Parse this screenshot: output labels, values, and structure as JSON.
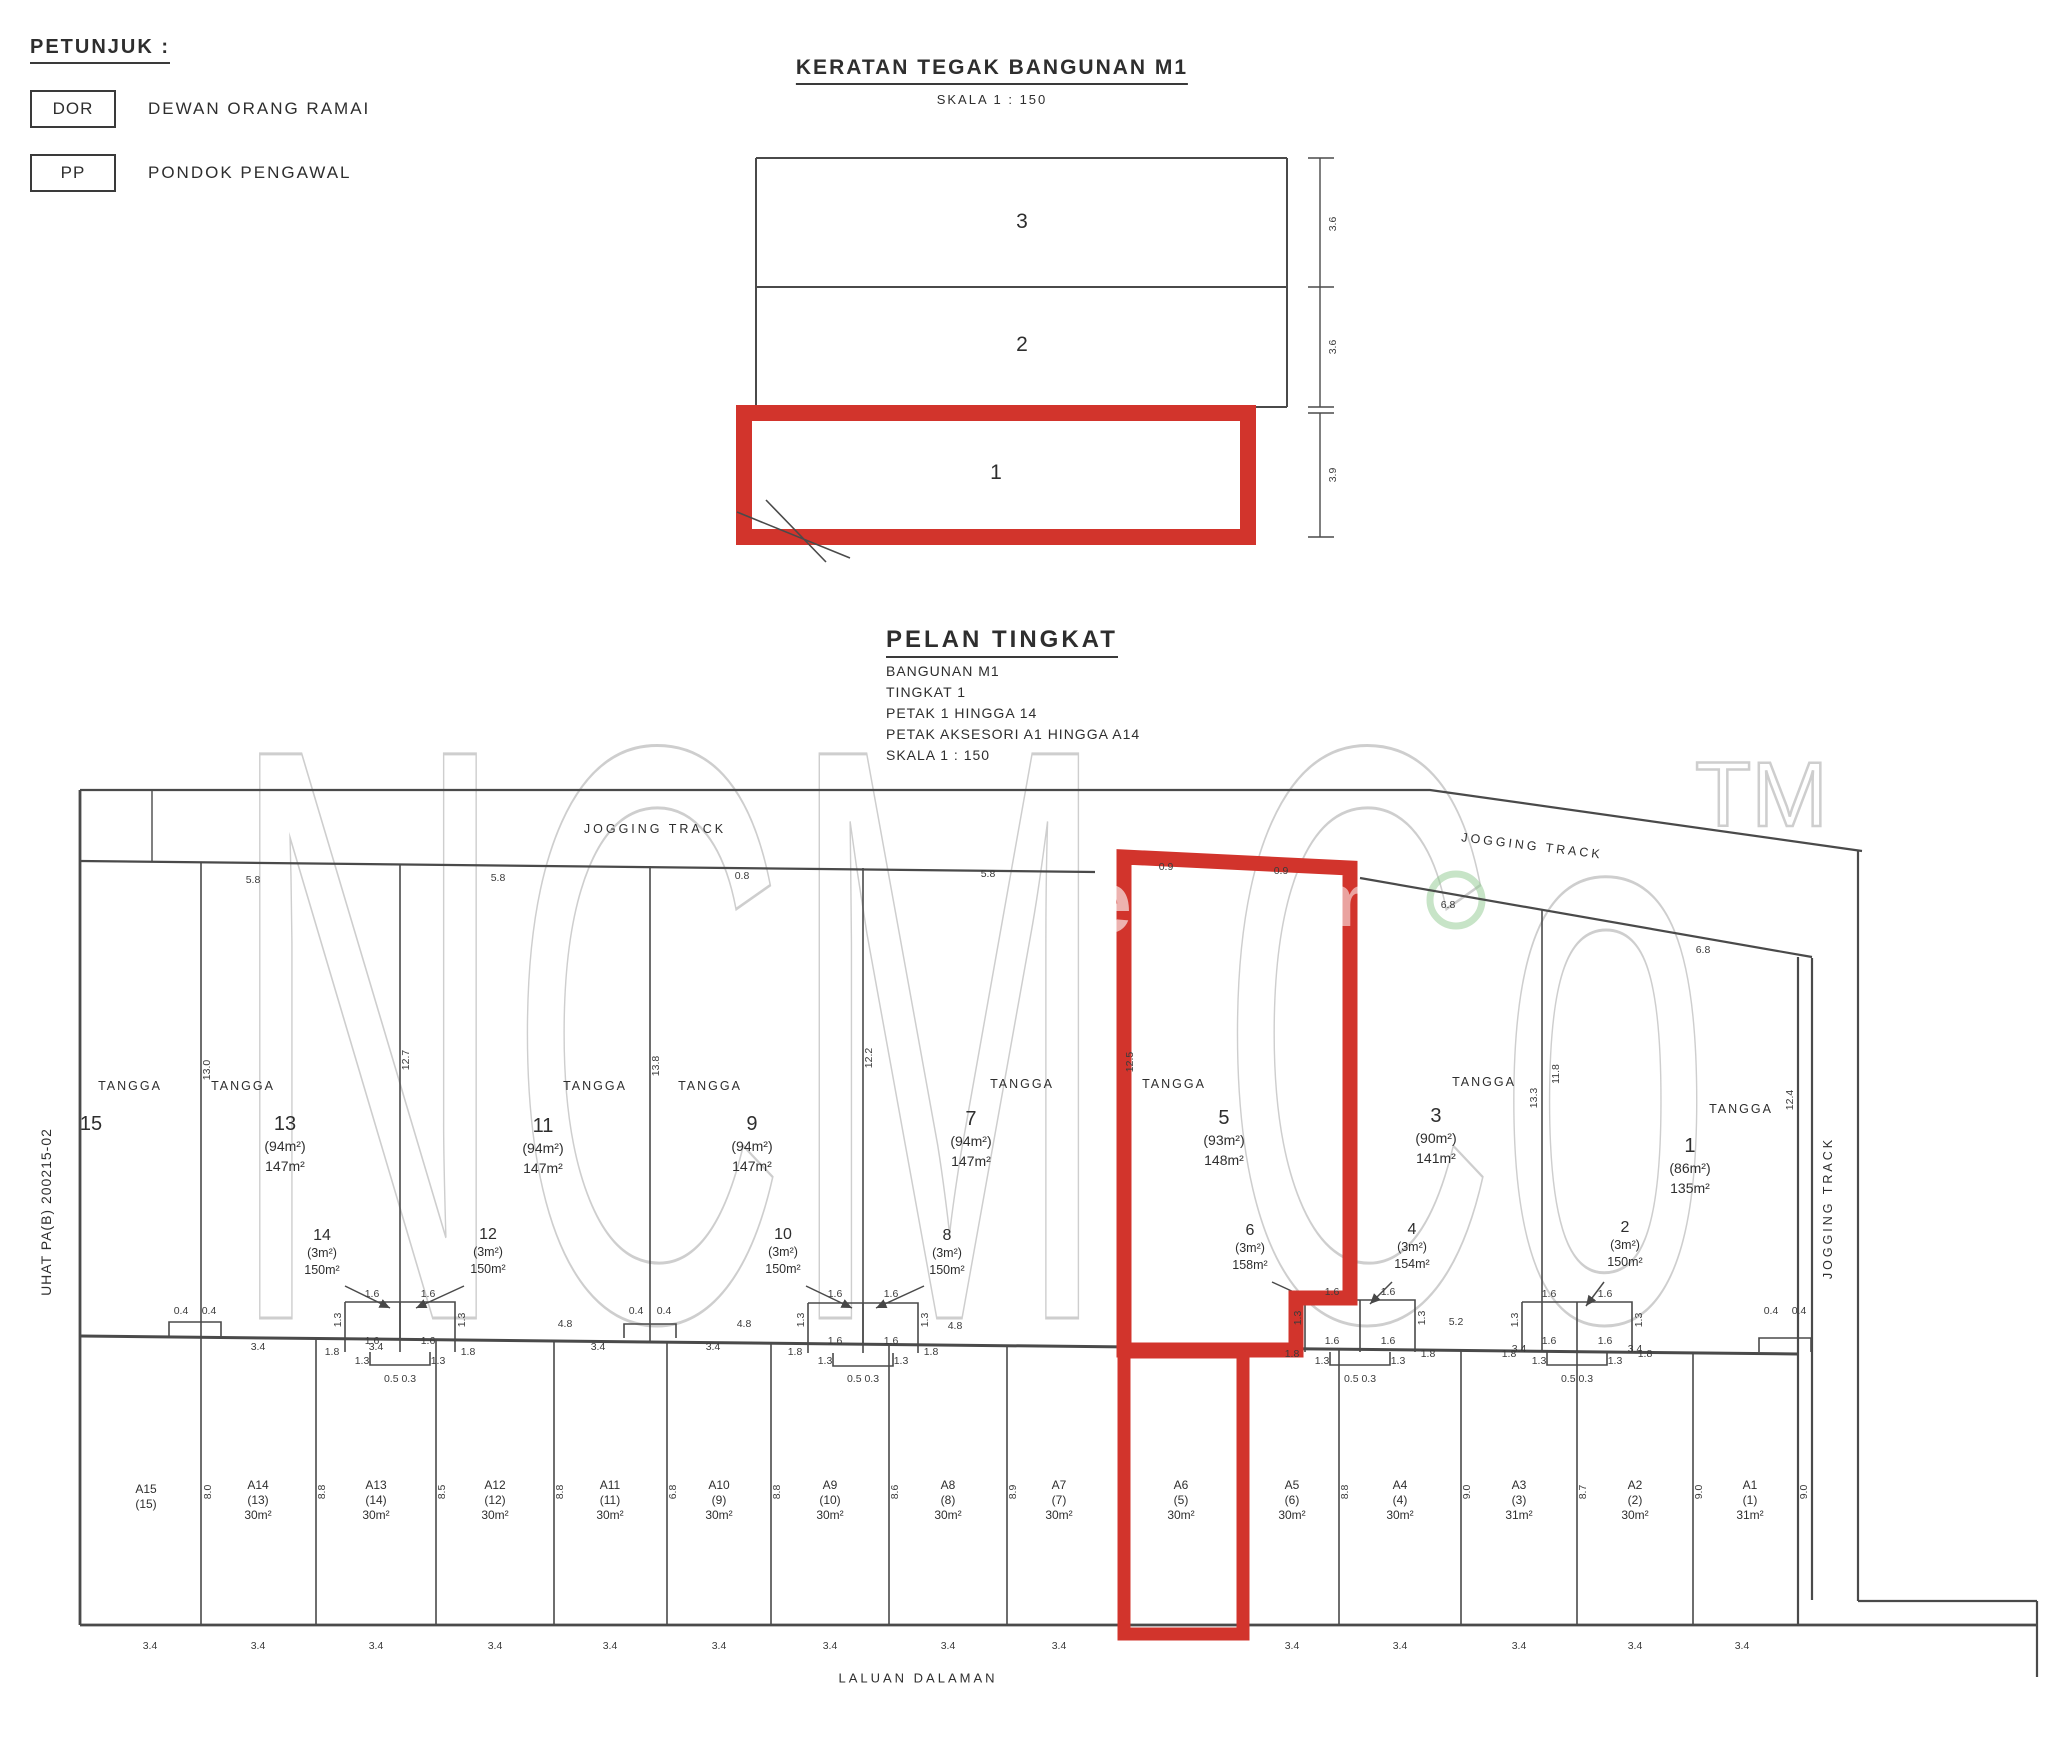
{
  "legend": {
    "title": "PETUNJUK :",
    "items": [
      {
        "code": "DOR",
        "label": "DEWAN ORANG RAMAI"
      },
      {
        "code": "PP",
        "label": "PONDOK PENGAWAL"
      }
    ]
  },
  "watermark": {
    "text": "NCM Co",
    "tm": "TM",
    "fragments": [
      "e",
      "m"
    ]
  },
  "section": {
    "title": "KERATAN TEGAK BANGUNAN M1",
    "scale": "SKALA 1 : 150",
    "floors": [
      {
        "v": "3",
        "x": 1022,
        "y": 222,
        "highlighted": false
      },
      {
        "v": "2",
        "x": 1022,
        "y": 345,
        "highlighted": false
      },
      {
        "v": "1",
        "x": 996,
        "y": 473,
        "highlighted": true
      }
    ],
    "dims": [
      {
        "v": "3.6",
        "x": 1333,
        "y": 224,
        "r": -90
      },
      {
        "v": "3.6",
        "x": 1333,
        "y": 347,
        "r": -90
      },
      {
        "v": "3.9",
        "x": 1333,
        "y": 475,
        "r": -90
      }
    ]
  },
  "plan": {
    "title": "PELAN TINGKAT",
    "subtitle_lines": [
      "BANGUNAN M1",
      "TINGKAT 1",
      "PETAK 1 HINGGA 14",
      "PETAK AKSESORI A1 HINGGA A14",
      "SKALA 1 : 150"
    ],
    "jogging_track_top_left": "JOGGING TRACK",
    "jogging_track_top_right": "JOGGING TRACK",
    "jogging_track_right": "JOGGING TRACK",
    "laluan_dalaman": "LALUAN DALAMAN",
    "side_note": "UHAT PA(B) 200215-02",
    "tangga": [
      {
        "v": "TANGGA",
        "x": 130,
        "y": 1086
      },
      {
        "v": "TANGGA",
        "x": 243,
        "y": 1086
      },
      {
        "v": "TANGGA",
        "x": 595,
        "y": 1086
      },
      {
        "v": "TANGGA",
        "x": 710,
        "y": 1086
      },
      {
        "v": "TANGGA",
        "x": 1022,
        "y": 1084
      },
      {
        "v": "TANGGA",
        "x": 1174,
        "y": 1084
      },
      {
        "v": "TANGGA",
        "x": 1484,
        "y": 1082
      },
      {
        "v": "TANGGA",
        "x": 1741,
        "y": 1109
      }
    ],
    "units": [
      {
        "no": "15",
        "x": 91,
        "y": 1112,
        "highlighted": false
      },
      {
        "no": "13",
        "acc": "(94m²)",
        "area": "147m²",
        "x": 285,
        "y": 1112,
        "highlighted": false
      },
      {
        "no": "11",
        "acc": "(94m²)",
        "area": "147m²",
        "x": 543,
        "y": 1114,
        "highlighted": false
      },
      {
        "no": "9",
        "acc": "(94m²)",
        "area": "147m²",
        "x": 752,
        "y": 1112,
        "highlighted": false
      },
      {
        "no": "7",
        "acc": "(94m²)",
        "area": "147m²",
        "x": 971,
        "y": 1107,
        "highlighted": false
      },
      {
        "no": "5",
        "acc": "(93m²)",
        "area": "148m²",
        "x": 1224,
        "y": 1106,
        "highlighted": true
      },
      {
        "no": "3",
        "acc": "(90m²)",
        "area": "141m²",
        "x": 1436,
        "y": 1104,
        "highlighted": false
      },
      {
        "no": "1",
        "acc": "(86m²)",
        "area": "135m²",
        "x": 1690,
        "y": 1134,
        "highlighted": false
      }
    ],
    "mid_units": [
      {
        "no": "14",
        "acc": "(3m²)",
        "area": "150m²",
        "x": 322,
        "y": 1226
      },
      {
        "no": "12",
        "acc": "(3m²)",
        "area": "150m²",
        "x": 488,
        "y": 1225
      },
      {
        "no": "10",
        "acc": "(3m²)",
        "area": "150m²",
        "x": 783,
        "y": 1225
      },
      {
        "no": "8",
        "acc": "(3m²)",
        "area": "150m²",
        "x": 947,
        "y": 1226
      },
      {
        "no": "6",
        "acc": "(3m²)",
        "area": "158m²",
        "x": 1250,
        "y": 1221
      },
      {
        "no": "4",
        "acc": "(3m²)",
        "area": "154m²",
        "x": 1412,
        "y": 1220
      },
      {
        "no": "2",
        "acc": "(3m²)",
        "area": "150m²",
        "x": 1625,
        "y": 1218
      }
    ],
    "accessories": [
      {
        "code": "A15",
        "ref": "(15)",
        "x": 146,
        "y": 1482,
        "highlighted": false
      },
      {
        "code": "A14",
        "ref": "(13)",
        "area": "30m²",
        "x": 258,
        "y": 1478,
        "highlighted": false
      },
      {
        "code": "A13",
        "ref": "(14)",
        "area": "30m²",
        "x": 376,
        "y": 1478,
        "highlighted": false
      },
      {
        "code": "A12",
        "ref": "(12)",
        "area": "30m²",
        "x": 495,
        "y": 1478,
        "highlighted": false
      },
      {
        "code": "A11",
        "ref": "(11)",
        "area": "30m²",
        "x": 610,
        "y": 1478,
        "highlighted": false
      },
      {
        "code": "A10",
        "ref": "(9)",
        "area": "30m²",
        "x": 719,
        "y": 1478,
        "highlighted": false
      },
      {
        "code": "A9",
        "ref": "(10)",
        "area": "30m²",
        "x": 830,
        "y": 1478,
        "highlighted": false
      },
      {
        "code": "A8",
        "ref": "(8)",
        "area": "30m²",
        "x": 948,
        "y": 1478,
        "highlighted": false
      },
      {
        "code": "A7",
        "ref": "(7)",
        "area": "30m²",
        "x": 1059,
        "y": 1478,
        "highlighted": false
      },
      {
        "code": "A6",
        "ref": "(5)",
        "area": "30m²",
        "x": 1181,
        "y": 1478,
        "highlighted": true
      },
      {
        "code": "A5",
        "ref": "(6)",
        "area": "30m²",
        "x": 1292,
        "y": 1478,
        "highlighted": false
      },
      {
        "code": "A4",
        "ref": "(4)",
        "area": "30m²",
        "x": 1400,
        "y": 1478,
        "highlighted": false
      },
      {
        "code": "A3",
        "ref": "(3)",
        "area": "31m²",
        "x": 1519,
        "y": 1478,
        "highlighted": false
      },
      {
        "code": "A2",
        "ref": "(2)",
        "area": "30m²",
        "x": 1635,
        "y": 1478,
        "highlighted": false
      },
      {
        "code": "A1",
        "ref": "(1)",
        "area": "31m²",
        "x": 1750,
        "y": 1478,
        "highlighted": false
      }
    ],
    "dims": [
      {
        "v": "5.8",
        "x": 253,
        "y": 880
      },
      {
        "v": "5.8",
        "x": 498,
        "y": 878
      },
      {
        "v": "0.8",
        "x": 742,
        "y": 876
      },
      {
        "v": "5.8",
        "x": 988,
        "y": 874
      },
      {
        "v": "0.9",
        "x": 1166,
        "y": 867
      },
      {
        "v": "0.9",
        "x": 1281,
        "y": 871
      },
      {
        "v": "6.8",
        "x": 1448,
        "y": 905
      },
      {
        "v": "6.8",
        "x": 1703,
        "y": 950
      },
      {
        "v": "13.0",
        "x": 207,
        "y": 1070,
        "r": -90
      },
      {
        "v": "12.7",
        "x": 406,
        "y": 1060,
        "r": -90
      },
      {
        "v": "13.8",
        "x": 656,
        "y": 1066,
        "r": -90
      },
      {
        "v": "12.2",
        "x": 869,
        "y": 1058,
        "r": -90
      },
      {
        "v": "12.5",
        "x": 1130,
        "y": 1062,
        "r": -90
      },
      {
        "v": "13.3",
        "x": 1534,
        "y": 1098,
        "r": -90
      },
      {
        "v": "11.8",
        "x": 1556,
        "y": 1074,
        "r": -90
      },
      {
        "v": "12.4",
        "x": 1790,
        "y": 1100,
        "r": -90
      },
      {
        "v": "8.0",
        "x": 208,
        "y": 1492,
        "r": -90
      },
      {
        "v": "8.8",
        "x": 322,
        "y": 1492,
        "r": -90
      },
      {
        "v": "8.5",
        "x": 442,
        "y": 1492,
        "r": -90
      },
      {
        "v": "8.8",
        "x": 560,
        "y": 1492,
        "r": -90
      },
      {
        "v": "6.8",
        "x": 673,
        "y": 1492,
        "r": -90
      },
      {
        "v": "8.8",
        "x": 777,
        "y": 1492,
        "r": -90
      },
      {
        "v": "8.6",
        "x": 895,
        "y": 1492,
        "r": -90
      },
      {
        "v": "8.9",
        "x": 1013,
        "y": 1492,
        "r": -90
      },
      {
        "v": "8.8",
        "x": 1345,
        "y": 1492,
        "r": -90
      },
      {
        "v": "9.0",
        "x": 1467,
        "y": 1492,
        "r": -90
      },
      {
        "v": "8.7",
        "x": 1583,
        "y": 1492,
        "r": -90
      },
      {
        "v": "9.0",
        "x": 1699,
        "y": 1492,
        "r": -90
      },
      {
        "v": "9.0",
        "x": 1804,
        "y": 1492,
        "r": -90
      },
      {
        "v": "3.4",
        "x": 150,
        "y": 1646
      },
      {
        "v": "3.4",
        "x": 258,
        "y": 1646
      },
      {
        "v": "3.4",
        "x": 376,
        "y": 1646
      },
      {
        "v": "3.4",
        "x": 495,
        "y": 1646
      },
      {
        "v": "3.4",
        "x": 610,
        "y": 1646
      },
      {
        "v": "3.4",
        "x": 719,
        "y": 1646
      },
      {
        "v": "3.4",
        "x": 830,
        "y": 1646
      },
      {
        "v": "3.4",
        "x": 948,
        "y": 1646
      },
      {
        "v": "3.4",
        "x": 1059,
        "y": 1646
      },
      {
        "v": "3.4",
        "x": 1292,
        "y": 1646
      },
      {
        "v": "3.4",
        "x": 1400,
        "y": 1646
      },
      {
        "v": "3.4",
        "x": 1519,
        "y": 1646
      },
      {
        "v": "3.4",
        "x": 1635,
        "y": 1646
      },
      {
        "v": "3.4",
        "x": 1742,
        "y": 1646
      },
      {
        "v": "3.4",
        "x": 258,
        "y": 1347
      },
      {
        "v": "3.4",
        "x": 376,
        "y": 1347
      },
      {
        "v": "3.4",
        "x": 598,
        "y": 1347
      },
      {
        "v": "3.4",
        "x": 713,
        "y": 1347
      },
      {
        "v": "3.4",
        "x": 1519,
        "y": 1349
      },
      {
        "v": "3.4",
        "x": 1635,
        "y": 1349
      },
      {
        "v": "4.8",
        "x": 565,
        "y": 1324
      },
      {
        "v": "4.8",
        "x": 744,
        "y": 1324
      },
      {
        "v": "4.8",
        "x": 955,
        "y": 1326
      },
      {
        "v": "5.2",
        "x": 1456,
        "y": 1322
      },
      {
        "v": "1.8",
        "x": 332,
        "y": 1352
      },
      {
        "v": "1.8",
        "x": 468,
        "y": 1352
      },
      {
        "v": "1.8",
        "x": 795,
        "y": 1352
      },
      {
        "v": "1.8",
        "x": 931,
        "y": 1352
      },
      {
        "v": "1.8",
        "x": 1292,
        "y": 1354
      },
      {
        "v": "1.8",
        "x": 1428,
        "y": 1354
      },
      {
        "v": "1.8",
        "x": 1509,
        "y": 1354
      },
      {
        "v": "1.8",
        "x": 1645,
        "y": 1354
      },
      {
        "v": "1.6",
        "x": 372,
        "y": 1294
      },
      {
        "v": "1.6",
        "x": 428,
        "y": 1294
      },
      {
        "v": "1.6",
        "x": 372,
        "y": 1341
      },
      {
        "v": "1.6",
        "x": 428,
        "y": 1341
      },
      {
        "v": "1.3",
        "x": 362,
        "y": 1361
      },
      {
        "v": "1.3",
        "x": 438,
        "y": 1361
      },
      {
        "v": "0.5 0.3",
        "x": 400,
        "y": 1379
      },
      {
        "v": "1.3",
        "x": 338,
        "y": 1320,
        "r": -90
      },
      {
        "v": "1.3",
        "x": 462,
        "y": 1320,
        "r": -90
      },
      {
        "v": "1.6",
        "x": 835,
        "y": 1294
      },
      {
        "v": "1.6",
        "x": 891,
        "y": 1294
      },
      {
        "v": "1.6",
        "x": 835,
        "y": 1341
      },
      {
        "v": "1.6",
        "x": 891,
        "y": 1341
      },
      {
        "v": "1.3",
        "x": 825,
        "y": 1361
      },
      {
        "v": "1.3",
        "x": 901,
        "y": 1361
      },
      {
        "v": "0.5 0.3",
        "x": 863,
        "y": 1379
      },
      {
        "v": "1.3",
        "x": 801,
        "y": 1320,
        "r": -90
      },
      {
        "v": "1.3",
        "x": 925,
        "y": 1320,
        "r": -90
      },
      {
        "v": "1.6",
        "x": 1332,
        "y": 1292
      },
      {
        "v": "1.6",
        "x": 1388,
        "y": 1292
      },
      {
        "v": "1.6",
        "x": 1332,
        "y": 1341
      },
      {
        "v": "1.6",
        "x": 1388,
        "y": 1341
      },
      {
        "v": "1.3",
        "x": 1322,
        "y": 1361
      },
      {
        "v": "1.3",
        "x": 1398,
        "y": 1361
      },
      {
        "v": "0.5 0.3",
        "x": 1360,
        "y": 1379
      },
      {
        "v": "1.3",
        "x": 1298,
        "y": 1318,
        "r": -90
      },
      {
        "v": "1.3",
        "x": 1422,
        "y": 1318,
        "r": -90
      },
      {
        "v": "1.6",
        "x": 1549,
        "y": 1294
      },
      {
        "v": "1.6",
        "x": 1605,
        "y": 1294
      },
      {
        "v": "1.6",
        "x": 1549,
        "y": 1341
      },
      {
        "v": "1.6",
        "x": 1605,
        "y": 1341
      },
      {
        "v": "1.3",
        "x": 1539,
        "y": 1361
      },
      {
        "v": "1.3",
        "x": 1615,
        "y": 1361
      },
      {
        "v": "0.5 0.3",
        "x": 1577,
        "y": 1379
      },
      {
        "v": "1.3",
        "x": 1515,
        "y": 1320,
        "r": -90
      },
      {
        "v": "1.3",
        "x": 1639,
        "y": 1320,
        "r": -90
      },
      {
        "v": "0.4",
        "x": 181,
        "y": 1311
      },
      {
        "v": "0.4",
        "x": 209,
        "y": 1311
      },
      {
        "v": "0.4",
        "x": 636,
        "y": 1311
      },
      {
        "v": "0.4",
        "x": 664,
        "y": 1311
      },
      {
        "v": "0.4",
        "x": 1771,
        "y": 1311
      },
      {
        "v": "0.4",
        "x": 1799,
        "y": 1311
      }
    ]
  }
}
